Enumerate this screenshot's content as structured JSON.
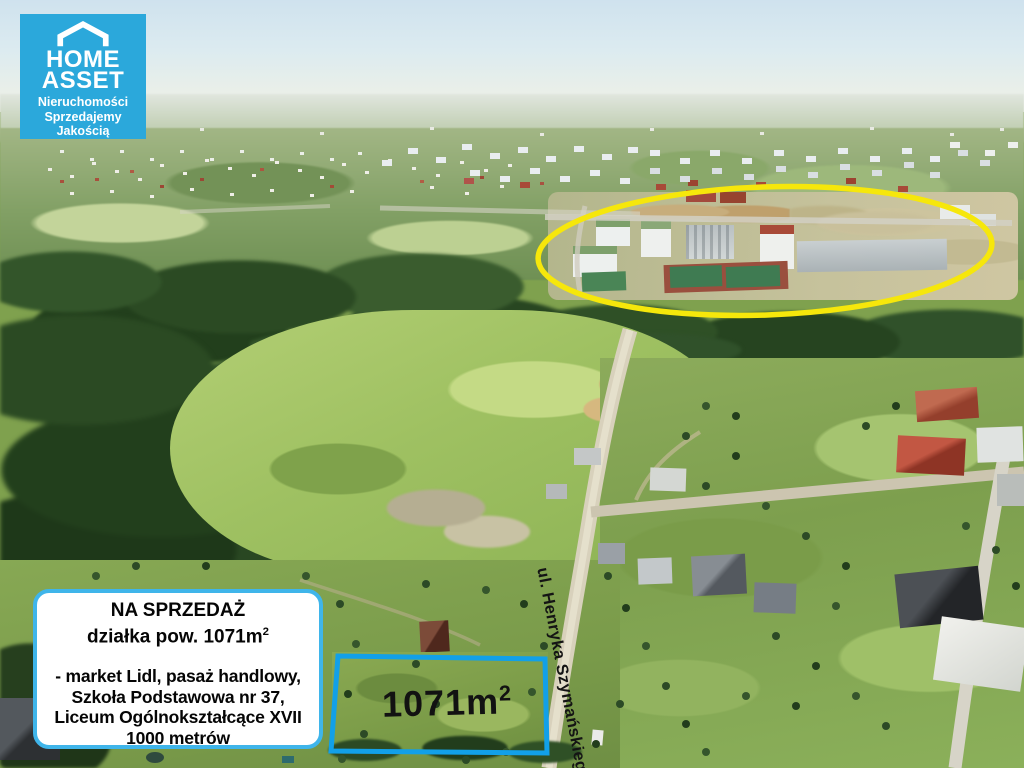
{
  "colors": {
    "brand-blue": "#2BA8DB",
    "box-border": "#3FB5EA",
    "highlight-yellow": "#F6E70B",
    "plot-blue": "#12A0E8"
  },
  "logo": {
    "name_line1": "HOME",
    "name_line2": "ASSET",
    "tagline": [
      "Nieruchomości",
      "Sprzedajemy",
      "Jakością"
    ]
  },
  "listing_box": {
    "title": "NA SPRZEDAŻ",
    "area_line": "działka pow. 1071m",
    "area_sup": "2",
    "features": [
      "- market Lidl, pasaż handlowy,",
      "Szkoła Podstawowa nr 37,",
      "Liceum Ogólnokształcące XVII",
      "1000 metrów"
    ]
  },
  "plot_label": {
    "area": "1071m",
    "sup": "2"
  },
  "street_label": "ul. Henryka Szymańskiego"
}
